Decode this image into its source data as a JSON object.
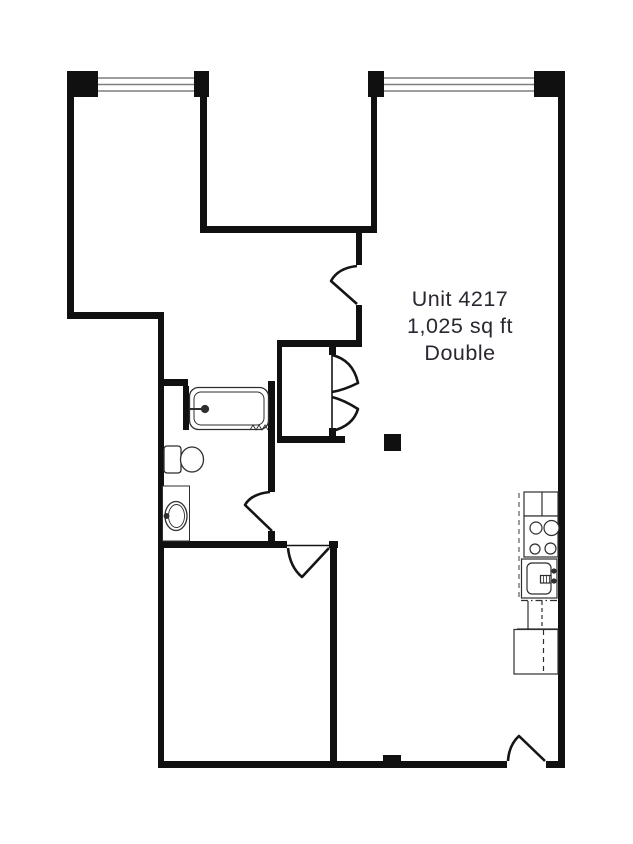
{
  "unit_label": {
    "line1": "Unit 4217",
    "line2": "1,025 sq ft",
    "line3": "Double"
  },
  "colors": {
    "background": "#ffffff",
    "wall": "#101010",
    "fixture_line": "#2e2e2e",
    "window_line": "#7f7f7f",
    "label_text": "#2b2630"
  },
  "icons": [
    "window",
    "door-swing",
    "closet-double-doors",
    "bathtub",
    "toilet",
    "vanity-sink",
    "stove-cooktop",
    "kitchen-sink",
    "refrigerator",
    "structural-column"
  ]
}
